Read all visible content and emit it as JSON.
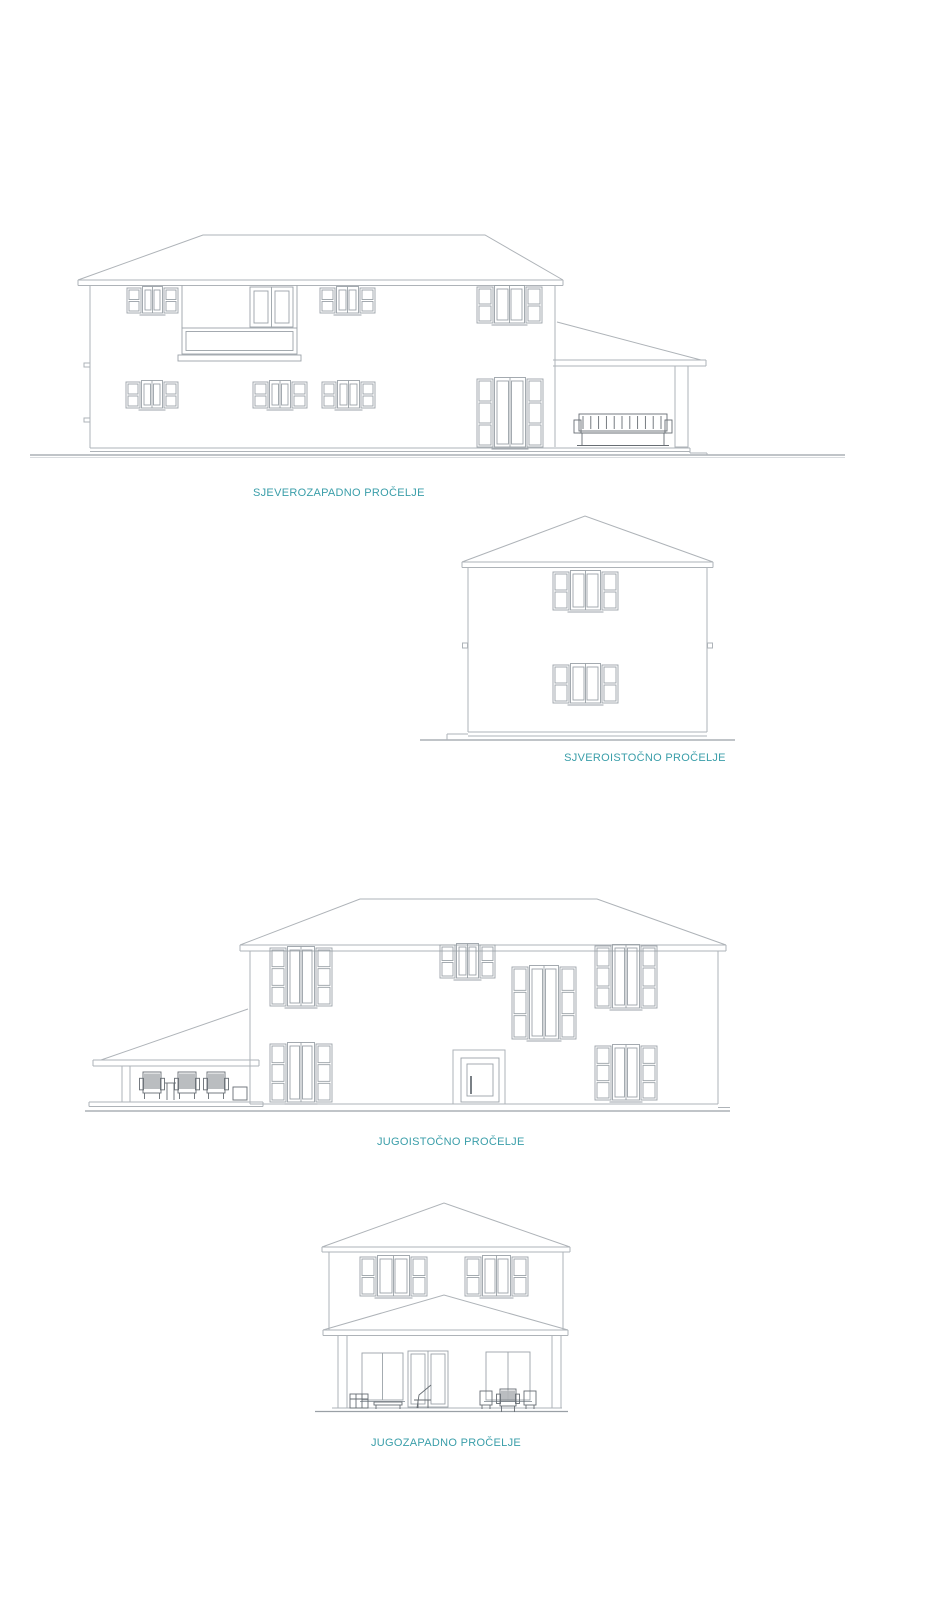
{
  "sheet": {
    "background_color": "#ffffff",
    "label_color": "#3a9ea9",
    "line_color": "#aeb3b8"
  },
  "elevations": [
    {
      "id": "northwest",
      "label": "SJEVEROZAPADNO PROČELJE"
    },
    {
      "id": "northeast",
      "label": "SJVEROISTOČNO PROČELJE"
    },
    {
      "id": "southeast",
      "label": "JUGOISTOČNO PROČELJE"
    },
    {
      "id": "southwest",
      "label": "JUGOZAPADNO PROČELJE"
    }
  ]
}
